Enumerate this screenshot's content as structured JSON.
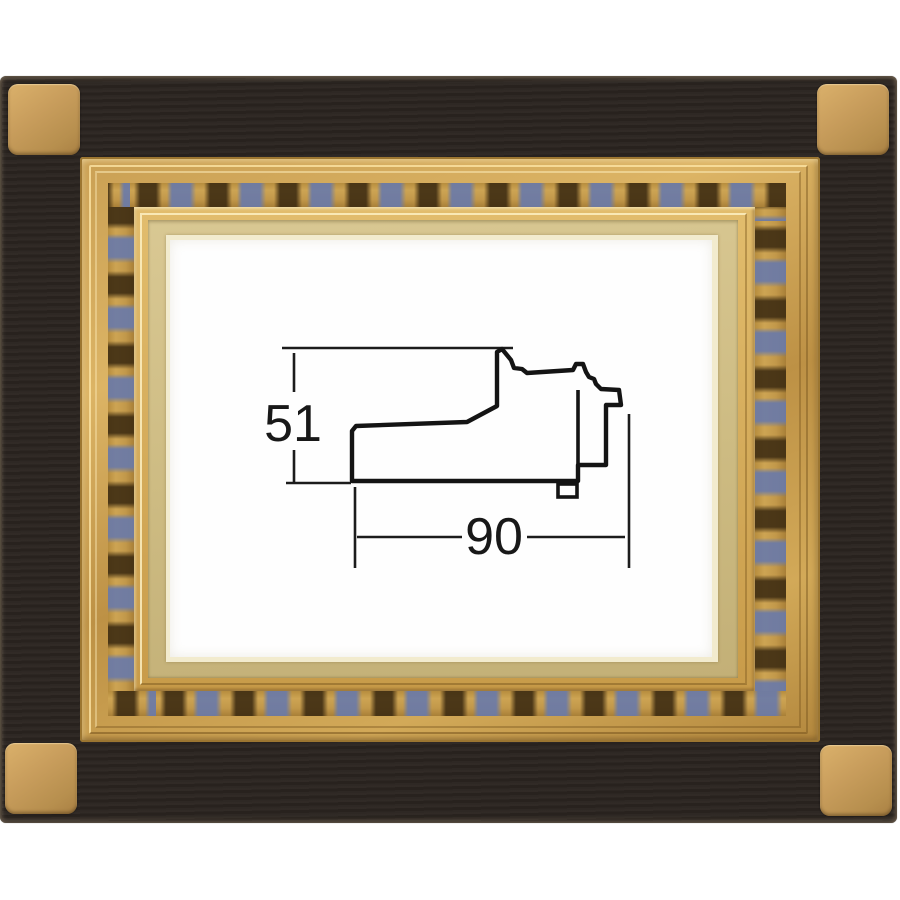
{
  "image": {
    "description": "Product photo of a picture frame: black outer frame with gold corner squares and an ornate gold inner frame, containing a technical cross-section diagram of the moulding profile",
    "background_color": "#ffffff"
  },
  "frame": {
    "outer_color": "#2a2420",
    "corner_square_color": "#c89d5c",
    "gold_color": "#c79a4a",
    "liner_color": "#d3c28a",
    "decor_dark_color": "#3a2910",
    "decor_blue_color": "#6a7aa8",
    "mat_color": "#fefefe"
  },
  "diagram": {
    "type": "moulding-cross-section",
    "line_color": "#141414",
    "height_label": "51",
    "width_label": "90",
    "dimensions": {
      "height": 51,
      "width": 90
    }
  }
}
